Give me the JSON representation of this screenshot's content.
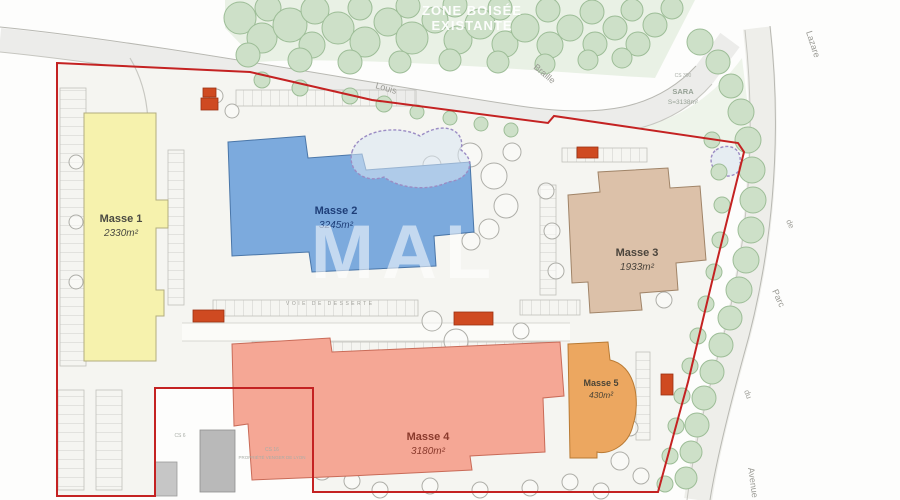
{
  "title": "Plan de masse",
  "watermark": "MAL",
  "zone": {
    "line1": "ZONE BOISÉE",
    "line2": "EXISTANTE"
  },
  "sara": {
    "ref": "CS 390",
    "name": "SARA",
    "area": "S=3138m²"
  },
  "internal_road_label": "VOIE DE DESSERTE",
  "property": {
    "ref": "CS 16",
    "name": "PROPRIÉTÉ VENGER DE LYON",
    "ref2": "CS 6"
  },
  "streets": [
    {
      "name": "Louis"
    },
    {
      "name": "Braille"
    },
    {
      "name": "Lazare"
    },
    {
      "name": "de"
    },
    {
      "name": "Parc"
    },
    {
      "name": "du"
    },
    {
      "name": "Avenue"
    }
  ],
  "masses": [
    {
      "name": "Masse 1",
      "area": "2330m²",
      "color": "#f6f2ad",
      "text_color": "#4a4a42"
    },
    {
      "name": "Masse 2",
      "area": "3245m²",
      "color": "#7caadd",
      "text_color": "#1e3e78"
    },
    {
      "name": "Masse 3",
      "area": "1933m²",
      "color": "#dcc1a9",
      "text_color": "#4a443c"
    },
    {
      "name": "Masse 4",
      "area": "3180m²",
      "color": "#f5a795",
      "text_color": "#8a3a2c"
    },
    {
      "name": "Masse 5",
      "area": "430m²",
      "color": "#eca760",
      "text_color": "#4a4436"
    }
  ],
  "colors": {
    "boundary": "#c42222",
    "tree_green": "#cde0c8",
    "marker_orange": "#cf4a21",
    "road_gray": "#ececea"
  },
  "decor": {
    "green_trees": [
      [
        240,
        18,
        16
      ],
      [
        268,
        8,
        13
      ],
      [
        262,
        38,
        15
      ],
      [
        290,
        25,
        17
      ],
      [
        315,
        10,
        14
      ],
      [
        312,
        45,
        13
      ],
      [
        338,
        28,
        16
      ],
      [
        360,
        8,
        12
      ],
      [
        365,
        42,
        15
      ],
      [
        388,
        22,
        14
      ],
      [
        408,
        6,
        12
      ],
      [
        412,
        38,
        16
      ],
      [
        435,
        20,
        13
      ],
      [
        455,
        5,
        12
      ],
      [
        458,
        40,
        14
      ],
      [
        480,
        24,
        15
      ],
      [
        500,
        8,
        12
      ],
      [
        505,
        44,
        13
      ],
      [
        525,
        28,
        14
      ],
      [
        548,
        10,
        12
      ],
      [
        550,
        45,
        13
      ],
      [
        570,
        28,
        13
      ],
      [
        592,
        12,
        12
      ],
      [
        595,
        44,
        12
      ],
      [
        615,
        28,
        12
      ],
      [
        632,
        10,
        11
      ],
      [
        638,
        44,
        12
      ],
      [
        655,
        25,
        12
      ],
      [
        672,
        8,
        11
      ],
      [
        248,
        55,
        12
      ],
      [
        300,
        60,
        12
      ],
      [
        350,
        62,
        12
      ],
      [
        400,
        62,
        11
      ],
      [
        450,
        60,
        11
      ],
      [
        498,
        62,
        11
      ],
      [
        545,
        64,
        10
      ],
      [
        588,
        60,
        10
      ],
      [
        622,
        58,
        10
      ],
      [
        262,
        80,
        8
      ],
      [
        300,
        88,
        8
      ],
      [
        350,
        96,
        8
      ],
      [
        384,
        104,
        8
      ],
      [
        417,
        112,
        7
      ],
      [
        450,
        118,
        7
      ],
      [
        481,
        124,
        7
      ],
      [
        511,
        130,
        7
      ],
      [
        700,
        42,
        13
      ],
      [
        718,
        62,
        12
      ],
      [
        731,
        86,
        12
      ],
      [
        741,
        112,
        13
      ],
      [
        748,
        140,
        13
      ],
      [
        752,
        170,
        13
      ],
      [
        753,
        200,
        13
      ],
      [
        751,
        230,
        13
      ],
      [
        746,
        260,
        13
      ],
      [
        739,
        290,
        13
      ],
      [
        730,
        318,
        12
      ],
      [
        721,
        345,
        12
      ],
      [
        712,
        372,
        12
      ],
      [
        704,
        398,
        12
      ],
      [
        697,
        425,
        12
      ],
      [
        691,
        452,
        11
      ],
      [
        686,
        478,
        11
      ],
      [
        712,
        140,
        8
      ],
      [
        719,
        172,
        8
      ],
      [
        722,
        205,
        8
      ],
      [
        720,
        240,
        8
      ],
      [
        714,
        272,
        8
      ],
      [
        706,
        304,
        8
      ],
      [
        698,
        336,
        8
      ],
      [
        690,
        366,
        8
      ],
      [
        682,
        396,
        8
      ],
      [
        676,
        426,
        8
      ],
      [
        670,
        456,
        8
      ],
      [
        665,
        484,
        8
      ]
    ],
    "plan_trees": [
      [
        470,
        155,
        12
      ],
      [
        494,
        176,
        13
      ],
      [
        506,
        206,
        12
      ],
      [
        489,
        229,
        10
      ],
      [
        471,
        241,
        9
      ],
      [
        512,
        152,
        9
      ],
      [
        432,
        321,
        10
      ],
      [
        456,
        341,
        12
      ],
      [
        471,
        366,
        11
      ],
      [
        486,
        391,
        10
      ],
      [
        496,
        411,
        9
      ],
      [
        462,
        421,
        8
      ],
      [
        440,
        396,
        9
      ],
      [
        521,
        331,
        8
      ],
      [
        546,
        191,
        8
      ],
      [
        552,
        231,
        8
      ],
      [
        556,
        271,
        8
      ],
      [
        322,
        471,
        9
      ],
      [
        352,
        481,
        8
      ],
      [
        620,
        461,
        9
      ],
      [
        641,
        476,
        8
      ],
      [
        601,
        491,
        8
      ],
      [
        216,
        96,
        7
      ],
      [
        232,
        111,
        7
      ],
      [
        76,
        162,
        7
      ],
      [
        76,
        222,
        7
      ],
      [
        76,
        282,
        7
      ],
      [
        651,
        210,
        8
      ],
      [
        658,
        245,
        8
      ],
      [
        664,
        300,
        8
      ],
      [
        432,
        165,
        9
      ],
      [
        450,
        180,
        8
      ],
      [
        380,
        490,
        8
      ],
      [
        430,
        486,
        8
      ],
      [
        480,
        490,
        8
      ],
      [
        530,
        488,
        8
      ],
      [
        570,
        482,
        8
      ],
      [
        630,
        428,
        8
      ]
    ],
    "stalls": [
      [
        60,
        88,
        26,
        278,
        "h"
      ],
      [
        58,
        390,
        26,
        100,
        "h"
      ],
      [
        96,
        390,
        26,
        100,
        "h"
      ],
      [
        168,
        150,
        16,
        155,
        "h"
      ],
      [
        236,
        90,
        180,
        16,
        "v"
      ],
      [
        213,
        300,
        205,
        16,
        "v"
      ],
      [
        520,
        300,
        60,
        15,
        "v"
      ],
      [
        540,
        185,
        16,
        110,
        "h"
      ],
      [
        636,
        352,
        14,
        88,
        "h"
      ],
      [
        562,
        148,
        85,
        14,
        "v"
      ],
      [
        252,
        342,
        305,
        12,
        "v"
      ]
    ],
    "markers": [
      [
        203,
        88,
        13,
        9
      ],
      [
        201,
        98,
        17,
        12
      ],
      [
        577,
        147,
        21,
        11
      ],
      [
        193,
        310,
        31,
        12
      ],
      [
        454,
        312,
        39,
        13
      ],
      [
        661,
        374,
        12,
        21
      ]
    ]
  }
}
